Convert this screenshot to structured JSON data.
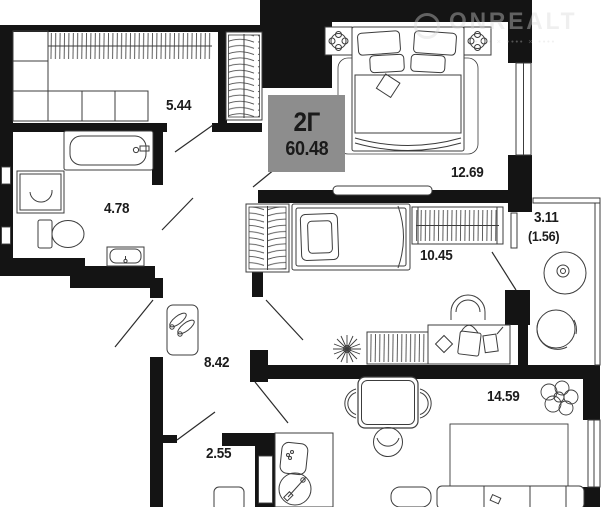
{
  "unit": {
    "type": "2Г",
    "total_area": "60.48"
  },
  "rooms": {
    "wardrobe": {
      "area": "5.44"
    },
    "bathroom": {
      "area": "4.78"
    },
    "bedroom": {
      "area": "12.69"
    },
    "bedroom2": {
      "area": "10.45"
    },
    "hallway": {
      "area": "8.42"
    },
    "storage": {
      "area": "2.55"
    },
    "kitchen_living": {
      "area": "14.59"
    },
    "balcony": {
      "area": "3.11",
      "area_reduced": "(1.56)"
    }
  },
  "watermark": {
    "brand": "ONREALT",
    "tagline": "•••• × •••• × ••••"
  },
  "colors": {
    "wall": "#141414",
    "furniture_stroke": "#3c3c3c",
    "label_text": "#1c1c1c",
    "badge_bg": "#8d8d8d"
  }
}
